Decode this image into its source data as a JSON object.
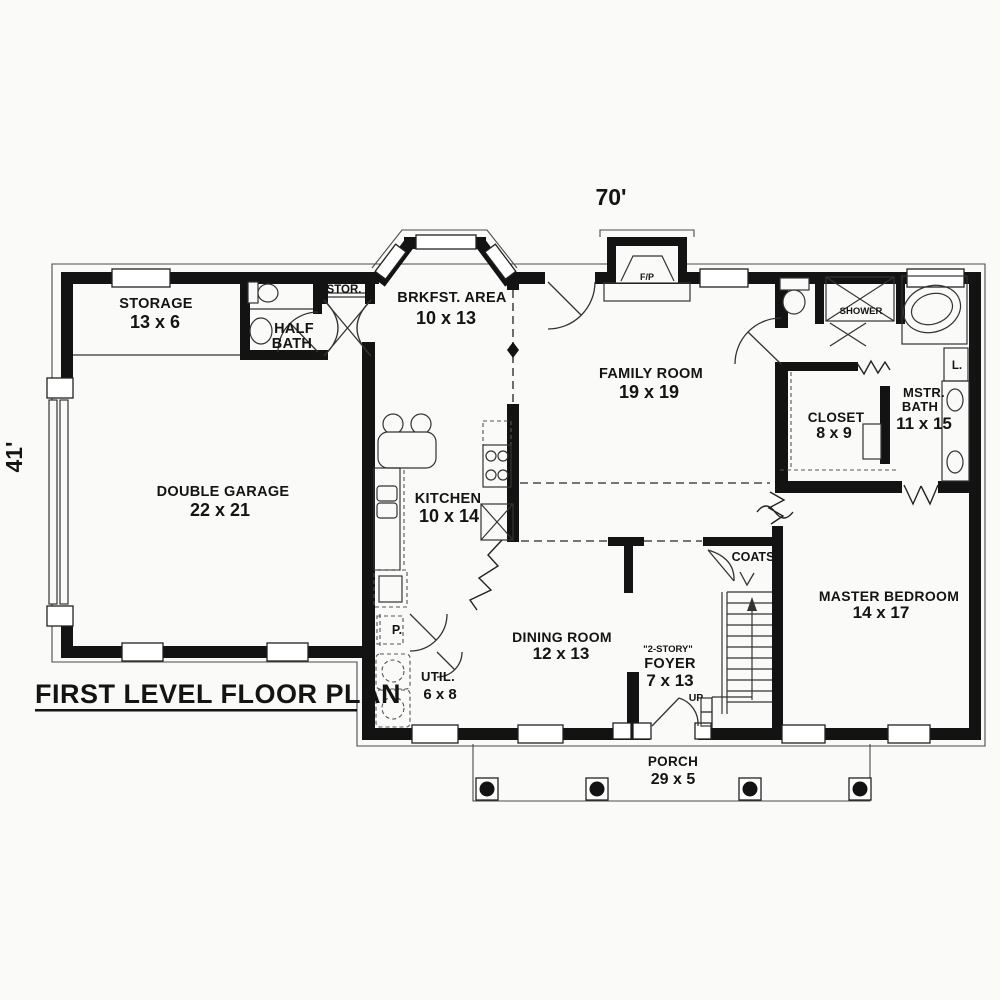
{
  "plan": {
    "title": "FIRST LEVEL FLOOR PLAN",
    "width_dim": "70'",
    "height_dim": "41'",
    "colors": {
      "walls": "#131313",
      "background": "#fafaf8",
      "lines": "#4a4a4a"
    },
    "rooms": {
      "storage": {
        "name": "STORAGE",
        "size": "13 x 6"
      },
      "half_bath": {
        "line1": "HALF",
        "line2": "BATH"
      },
      "stor_closet": {
        "name": "STOR."
      },
      "breakfast": {
        "name": "BRKFST. AREA",
        "size": "10 x 13"
      },
      "family": {
        "name": "FAMILY ROOM",
        "size": "19 x 19"
      },
      "fireplace": {
        "name": "F/P"
      },
      "garage": {
        "name": "DOUBLE GARAGE",
        "size": "22 x 21"
      },
      "kitchen": {
        "name": "KITCHEN",
        "size": "10 x 14"
      },
      "shower": {
        "name": "SHOWER"
      },
      "master_bath": {
        "line1": "MSTR.",
        "line2": "BATH",
        "size": "11 x 15"
      },
      "linen": {
        "name": "L."
      },
      "closet": {
        "name": "CLOSET",
        "size": "8 x 9"
      },
      "master_bedroom": {
        "name": "MASTER BEDROOM",
        "size": "14 x 17"
      },
      "coats": {
        "name": "COATS"
      },
      "dining": {
        "name": "DINING ROOM",
        "size": "12 x 13"
      },
      "foyer": {
        "prefix": "\"2-STORY\"",
        "name": "FOYER",
        "size": "7 x 13"
      },
      "stairs": {
        "label": "UP"
      },
      "pantry": {
        "name": "P."
      },
      "utility": {
        "name": "UTIL.",
        "size": "6 x 8"
      },
      "porch": {
        "name": "PORCH",
        "size": "29 x 5"
      }
    }
  }
}
